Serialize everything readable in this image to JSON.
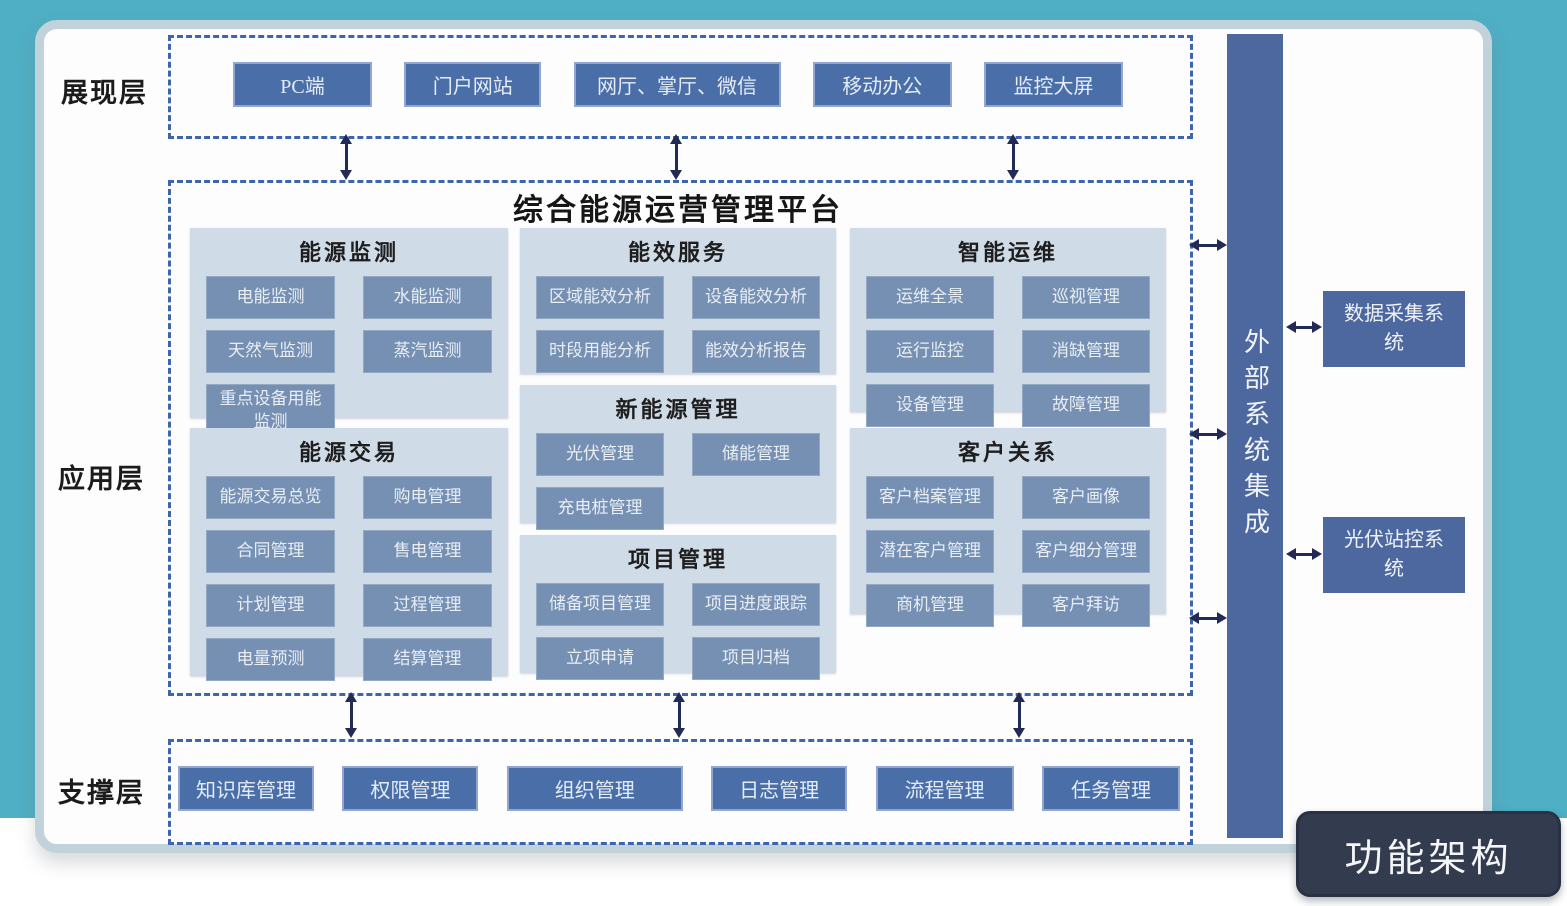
{
  "diagram": {
    "badge": "功能架构",
    "platform_title": "综合能源运营管理平台",
    "colors": {
      "teal_background": "#4fafc4",
      "dashed_border": "#3d64ae",
      "dark_box": "#4a6fa8",
      "group_panel": "#cfdbe7",
      "module_box": "#7590b3",
      "external_bar": "#4d689e",
      "badge_background": "#333b4e",
      "arrow": "#232a54"
    }
  },
  "layers": {
    "presentation": {
      "label": "展现层",
      "items": [
        "PC端",
        "门户网站",
        "网厅、掌厅、微信",
        "移动办公",
        "监控大屏"
      ]
    },
    "application": {
      "label": "应用层",
      "groups": [
        {
          "title": "能源监测",
          "items": [
            "电能监测",
            "水能监测",
            "天然气监测",
            "蒸汽监测",
            "重点设备用能监测"
          ]
        },
        {
          "title": "能效服务",
          "items": [
            "区域能效分析",
            "设备能效分析",
            "时段用能分析",
            "能效分析报告"
          ]
        },
        {
          "title": "智能运维",
          "items": [
            "运维全景",
            "巡视管理",
            "运行监控",
            "消缺管理",
            "设备管理",
            "故障管理"
          ]
        },
        {
          "title": "能源交易",
          "items": [
            "能源交易总览",
            "购电管理",
            "合同管理",
            "售电管理",
            "计划管理",
            "过程管理",
            "电量预测",
            "结算管理"
          ]
        },
        {
          "title": "新能源管理",
          "items": [
            "光伏管理",
            "储能管理",
            "充电桩管理"
          ]
        },
        {
          "title": "项目管理",
          "items": [
            "储备项目管理",
            "项目进度跟踪",
            "立项申请",
            "项目归档"
          ]
        },
        {
          "title": "客户关系",
          "items": [
            "客户档案管理",
            "客户画像",
            "潜在客户管理",
            "客户细分管理",
            "商机管理",
            "客户拜访"
          ]
        }
      ]
    },
    "support": {
      "label": "支撑层",
      "items": [
        "知识库管理",
        "权限管理",
        "组织管理",
        "日志管理",
        "流程管理",
        "任务管理"
      ]
    },
    "external": {
      "bar_label": "外部系统集成",
      "systems": [
        "数据采集系统",
        "光伏站控系统"
      ]
    }
  }
}
